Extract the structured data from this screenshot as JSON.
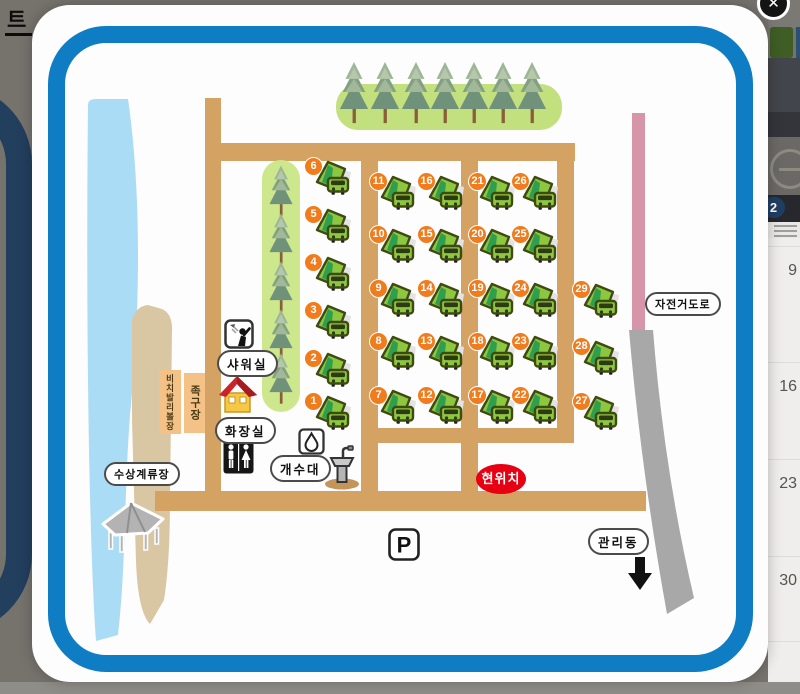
{
  "overlay": {
    "background_text_fragment": "트",
    "close_label": "✕",
    "side_panel": {
      "selected_date": "2",
      "calendar_dates": [
        {
          "label": "9",
          "y": 262
        },
        {
          "label": "16",
          "y": 378
        },
        {
          "label": "23",
          "y": 475
        },
        {
          "label": "30",
          "y": 572
        }
      ]
    }
  },
  "map": {
    "labels": {
      "shower": "샤워실",
      "toilet": "화장실",
      "sink": "개수대",
      "water_mooring": "수상계류장",
      "bicycle_road": "자전거도로",
      "office": "관리동",
      "current_location": "현위치",
      "parking": "P",
      "beach_volleyball": "비치발리볼장",
      "foot_volleyball": "족구장"
    },
    "sites": [
      {
        "n": "6",
        "x": 304,
        "y": 157
      },
      {
        "n": "5",
        "x": 304,
        "y": 205
      },
      {
        "n": "4",
        "x": 304,
        "y": 253
      },
      {
        "n": "3",
        "x": 304,
        "y": 301
      },
      {
        "n": "2",
        "x": 304,
        "y": 349
      },
      {
        "n": "1",
        "x": 304,
        "y": 392
      },
      {
        "n": "11",
        "x": 369,
        "y": 172
      },
      {
        "n": "10",
        "x": 369,
        "y": 225
      },
      {
        "n": "9",
        "x": 369,
        "y": 279
      },
      {
        "n": "8",
        "x": 369,
        "y": 332
      },
      {
        "n": "7",
        "x": 369,
        "y": 386
      },
      {
        "n": "16",
        "x": 417,
        "y": 172
      },
      {
        "n": "15",
        "x": 417,
        "y": 225
      },
      {
        "n": "14",
        "x": 417,
        "y": 279
      },
      {
        "n": "13",
        "x": 417,
        "y": 332
      },
      {
        "n": "12",
        "x": 417,
        "y": 386
      },
      {
        "n": "21",
        "x": 468,
        "y": 172
      },
      {
        "n": "20",
        "x": 468,
        "y": 225
      },
      {
        "n": "19",
        "x": 468,
        "y": 279
      },
      {
        "n": "18",
        "x": 468,
        "y": 332
      },
      {
        "n": "17",
        "x": 468,
        "y": 386
      },
      {
        "n": "26",
        "x": 511,
        "y": 172
      },
      {
        "n": "25",
        "x": 511,
        "y": 225
      },
      {
        "n": "24",
        "x": 511,
        "y": 279
      },
      {
        "n": "23",
        "x": 511,
        "y": 332
      },
      {
        "n": "22",
        "x": 511,
        "y": 386
      },
      {
        "n": "29",
        "x": 572,
        "y": 280
      },
      {
        "n": "28",
        "x": 572,
        "y": 337
      },
      {
        "n": "27",
        "x": 572,
        "y": 392
      }
    ],
    "trees": {
      "top_row": {
        "y": 58,
        "w": 32,
        "h": 70,
        "xs": [
          338,
          369,
          400,
          429,
          458,
          487,
          516
        ]
      },
      "left_col": {
        "x": 266,
        "w": 30,
        "h": 54,
        "ys": [
          164,
          212,
          260,
          308,
          352
        ]
      }
    },
    "colors": {
      "modal_border_blue": "#0e7dc3",
      "road_tan": "#d4a263",
      "water_blue": "#aadcf6",
      "beach_sand": "#d9c7a3",
      "grass_green": "#c3e07e",
      "site_badge_orange": "#f07c1e",
      "camper_green": "#8dc63f",
      "current_location_red": "#e60012",
      "bicycle_road_pink": "#d795aa",
      "exit_road_gray": "#a8a8a8"
    }
  }
}
